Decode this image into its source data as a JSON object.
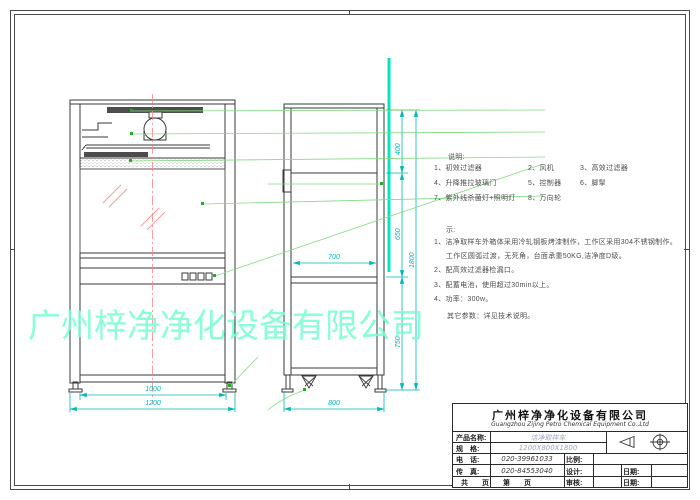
{
  "watermark": {
    "text": "广州梓净净化设备有限公司",
    "color": "#74ffd1"
  },
  "notes": {
    "heading": "说明:",
    "items": [
      "1、初效过滤器",
      "2、风机",
      "3、高效过滤器",
      "4、升降推拉玻璃门",
      "5、控制器",
      "6、脚掣",
      "7、紫外线杀菌灯+照明灯",
      "8、万向轮"
    ],
    "remark_heading": "示:",
    "remarks": [
      "1、洁净取样车外箱体采用冷轧钢板烤漆制作，工作区采用304不锈钢制作。",
      "工作区圆弧过渡，无死角，台面承重50KG,洁净度D级。",
      "2、配高效过滤器检漏口。",
      "3、配蓄电池，使用超过30min以上。",
      "4、功率：300w。"
    ],
    "other_params": "其它参数：详见技术说明。"
  },
  "dims": {
    "front_inner": "1000",
    "front_overall": "1200",
    "side_inner": "700",
    "side_overall": "800",
    "h_top": "400",
    "h_mid": "650",
    "h_low": "750",
    "h_overall": "1800"
  },
  "title_block": {
    "company_cn": "广州梓净净化设备有限公司",
    "company_en": "Guangzhou Zijing Petro Chemical Equipment Co.,Ltd",
    "product_label": "产品名称:",
    "product_value": "洁净取样车",
    "spec_label": "规　格:",
    "spec_value": "1200X800X1800",
    "tel_label": "电　话:",
    "tel_value": "020-39961033",
    "fax_label": "传　真:",
    "fax_value": "020-84553040",
    "scale_label": "比例:",
    "design_label": "设计:",
    "audit_label": "审核:",
    "date_label1": "日期:",
    "date_label2": "日期:",
    "pages_label": "共　　页　　第　　页"
  },
  "colors": {
    "dimension": "#00b8b8",
    "leader": "#86d986",
    "centerline": "#ff8585",
    "highlight": "#00e5c2",
    "glass_hatch": "#ff9a9a",
    "line": "#3a3a3a"
  }
}
